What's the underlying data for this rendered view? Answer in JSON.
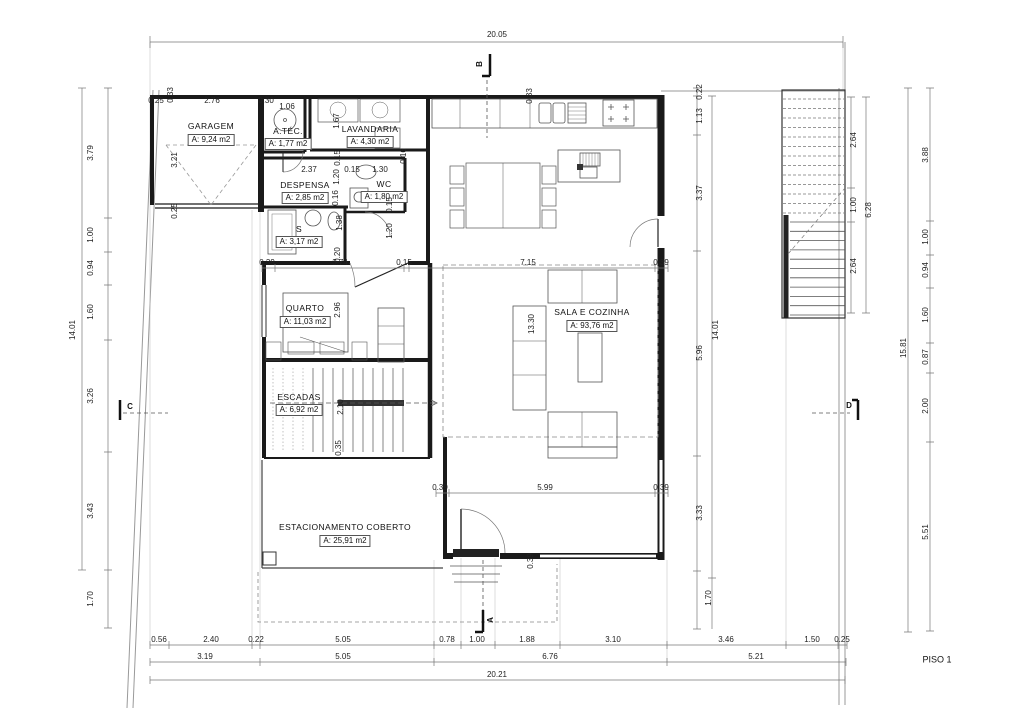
{
  "floor_label": "PISO 1",
  "colors": {
    "wall": "#1a1a1a",
    "dim_line": "#777777",
    "furniture": "#555555"
  },
  "sections": {
    "a": "A",
    "b": "B",
    "c": "C",
    "d": "D"
  },
  "rooms": {
    "garagem": {
      "name": "GARAGEM",
      "area": "A: 9,24 m2"
    },
    "atec": {
      "name": "A.TÉC.",
      "area": "A: 1,77 m2"
    },
    "lavandaria": {
      "name": "LAVANDARIA",
      "area": "A: 4,30 m2"
    },
    "despensa": {
      "name": "DESPENSA",
      "area": "A: 2,85 m2"
    },
    "wc": {
      "name": "WC",
      "area": "A: 1,80 m2"
    },
    "s": {
      "name": "S",
      "area": "A: 3,17 m2"
    },
    "quarto": {
      "name": "QUARTO",
      "area": "A: 11,03 m2"
    },
    "escadas": {
      "name": "ESCADAS",
      "area": "A: 6,92 m2"
    },
    "sala": {
      "name": "SALA E COZINHA",
      "area": "A: 93,76 m2"
    },
    "estacionamento": {
      "name": "ESTACIONAMENTO COBERTO",
      "area": "A: 25,91 m2"
    }
  },
  "dims": {
    "top_total": "20.05",
    "garage_top": [
      "0.25",
      "2.76",
      "0.30",
      "1.06"
    ],
    "garage_left_col": [
      "0.33",
      "3.21",
      "0.25"
    ],
    "lavandaria_col": [
      "1.67",
      "0.16"
    ],
    "kitchen_col": [
      "0.33"
    ],
    "despensa_row": [
      "2.37",
      "0.15",
      "1.30"
    ],
    "hall_col": [
      "0.15",
      "1.20",
      "0.16",
      "1.38",
      "0.20"
    ],
    "wc_col": [
      "0.15",
      "1.20"
    ],
    "quarto_height": "2.96",
    "stairs_room_col": [
      "2.10",
      "0.35"
    ],
    "sala_height": "13.30",
    "wall_height": "0.39",
    "mid_row": [
      "0.39",
      "3.74",
      "0.15",
      "7.15",
      "0.39"
    ],
    "lower_row": [
      "0.39",
      "5.99",
      "0.39"
    ],
    "left_col": [
      "3.79",
      "1.00",
      "0.94",
      "1.60",
      "3.26",
      "3.43",
      "1.70"
    ],
    "left_total": "14.01",
    "mid_col": [
      "0.22",
      "1.13",
      "3.37",
      "5.96",
      "3.33",
      "1.70"
    ],
    "mid_total": "14.01",
    "stair_col": [
      "2.64",
      "1.00",
      "2.64"
    ],
    "stair_total": "6.28",
    "right_col": [
      "3.88",
      "1.00",
      "0.94",
      "1.60",
      "0.87",
      "2.00",
      "5.51"
    ],
    "right_total": "15.81",
    "bottom_row1": [
      "0.56",
      "2.40",
      "0.22",
      "5.05",
      "0.78",
      "1.00",
      "1.88",
      "3.10",
      "3.46",
      "1.50",
      "0.25"
    ],
    "bottom_row2": [
      "3.19",
      "5.05",
      "6.76",
      "5.21"
    ],
    "bottom_total": "20.21"
  }
}
